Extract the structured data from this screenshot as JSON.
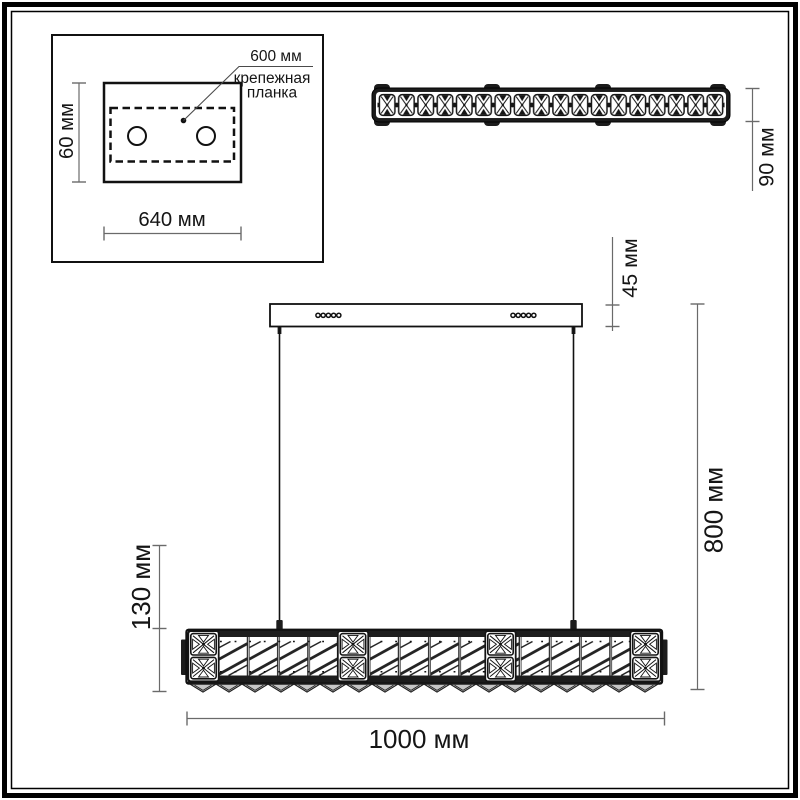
{
  "title": "Подвесной светильник — габаритный чертёж",
  "colors": {
    "drawing_line": "#161616",
    "dimension_line": "#6a6a6a",
    "text": "#151515",
    "crystal_fill": "#c6c6c6",
    "background": "#ffffff"
  },
  "inset": {
    "hole_spacing_label": "600 мм",
    "caption_line1": "крепежная",
    "caption_line2": "планка",
    "height_label": "60 мм",
    "width_label": "640 мм"
  },
  "top_view": {
    "depth_label": "90 мм"
  },
  "front_view": {
    "canopy_height_label": "45 мм",
    "overall_height_label": "800 мм",
    "bar_height_label": "130 мм",
    "bar_width_label": "1000 мм"
  }
}
